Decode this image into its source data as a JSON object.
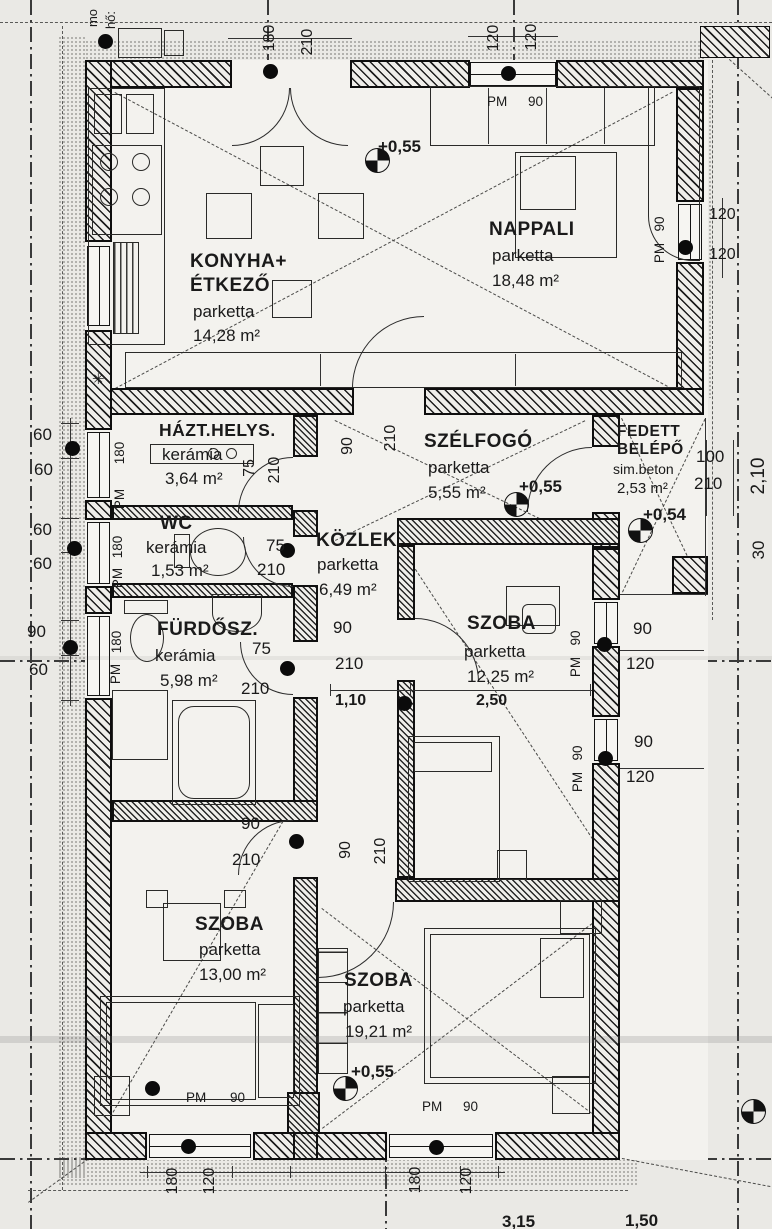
{
  "rooms": {
    "konyha": {
      "name1": "KONYHA+",
      "name2": "ÉTKEZŐ",
      "material": "parketta",
      "area": "14,28 m²"
    },
    "nappali": {
      "name1": "NAPPALI",
      "material": "parketta",
      "area": "18,48 m²"
    },
    "hazt": {
      "name1": "HÁZT.HELYS.",
      "material": "kerámia",
      "area": "3,64 m²"
    },
    "szelfogo": {
      "name1": "SZÉLFOGÓ",
      "material": "parketta",
      "area": "5,55 m²"
    },
    "fedett": {
      "name1": "FEDETT",
      "name2": "BELÉPŐ",
      "material": "sim.beton",
      "area": "2,53 m²"
    },
    "wc": {
      "name1": "WC",
      "material": "kerámia",
      "area": "1,53 m²"
    },
    "kozlek": {
      "name1": "KÖZLEK.",
      "material": "parketta",
      "area": "6,49 m²"
    },
    "furdo": {
      "name1": "FÜRDŐSZ.",
      "material": "kerámia",
      "area": "5,98 m²"
    },
    "szoba1": {
      "name1": "SZOBA",
      "material": "parketta",
      "area": "12,25 m²"
    },
    "szoba2": {
      "name1": "SZOBA",
      "material": "parketta",
      "area": "13,00 m²"
    },
    "szoba3": {
      "name1": "SZOBA",
      "material": "parketta",
      "area": "19,21 m²"
    }
  },
  "levels": {
    "l1": "+0,55",
    "l2": "+0,55",
    "l3": "+0,54",
    "l4": "+0,55"
  },
  "misc": {
    "drain": "✳"
  },
  "dims": [
    "180",
    "210",
    "120",
    "120",
    "PM",
    "90",
    "90",
    "PM",
    "120",
    "120",
    "60",
    "60",
    "60",
    "60",
    "90",
    "60",
    "180",
    "PM",
    "180",
    "PM",
    "180",
    "PM",
    "75",
    "210",
    "75",
    "210",
    "90",
    "210",
    "100",
    "210",
    "2,10",
    "30",
    "75",
    "210",
    "90",
    "210",
    "1,10",
    "2,50",
    "90",
    "120",
    "90",
    "120",
    "90",
    "PM",
    "90",
    "PM",
    "90",
    "210",
    "90",
    "210",
    "PM",
    "90",
    "PM",
    "90",
    "180",
    "120",
    "180",
    "120",
    "3,15",
    "1,50",
    "mo",
    "hő:"
  ]
}
